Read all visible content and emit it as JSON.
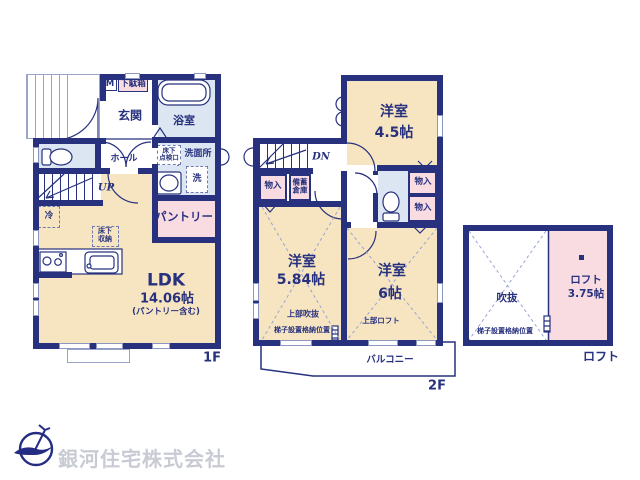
{
  "colors": {
    "wall": "#27317e",
    "room_beige": "#f7e5c2",
    "room_pink": "#f8dce2",
    "room_blue": "#dbe6f2",
    "dashed_line": "#97a4d2",
    "logo_text_gray": "#c9cbd4"
  },
  "f1": {
    "floor_label": "1F",
    "genkan": "玄関",
    "meter": "M",
    "shoebox": "下駄箱",
    "bath": "浴室",
    "washroom": "洗面所",
    "hatch_l1": "床下",
    "hatch_l2": "点検口",
    "washer": "洗",
    "hall": "ホール",
    "up": "UP",
    "fridge": "冷",
    "ufs_l1": "床下",
    "ufs_l2": "収納",
    "pantry": "パントリー",
    "ldk": "LDK",
    "ldk_size": "14.06帖",
    "ldk_note": "(パントリー含む)"
  },
  "f2": {
    "floor_label": "2F",
    "dn": "DN",
    "room_a": "洋室",
    "room_a_size": "4.5帖",
    "closet_a": "物入",
    "stock_l1": "備蓄",
    "stock_l2": "倉庫",
    "closet_b": "物入",
    "closet_c": "物入",
    "room_b": "洋室",
    "room_b_size": "5.84帖",
    "room_b_note1": "上部吹抜",
    "room_b_note2": "梯子設置格納位置",
    "room_c": "洋室",
    "room_c_size": "6帖",
    "room_c_note": "上部ロフト",
    "balcony": "バルコニー"
  },
  "loft": {
    "floor_label": "ロフト",
    "void": "吹抜",
    "ladder": "梯子設置格納位置",
    "room": "ロフト",
    "room_size": "3.75帖"
  },
  "footer": {
    "company": "銀河住宅株式会社"
  }
}
